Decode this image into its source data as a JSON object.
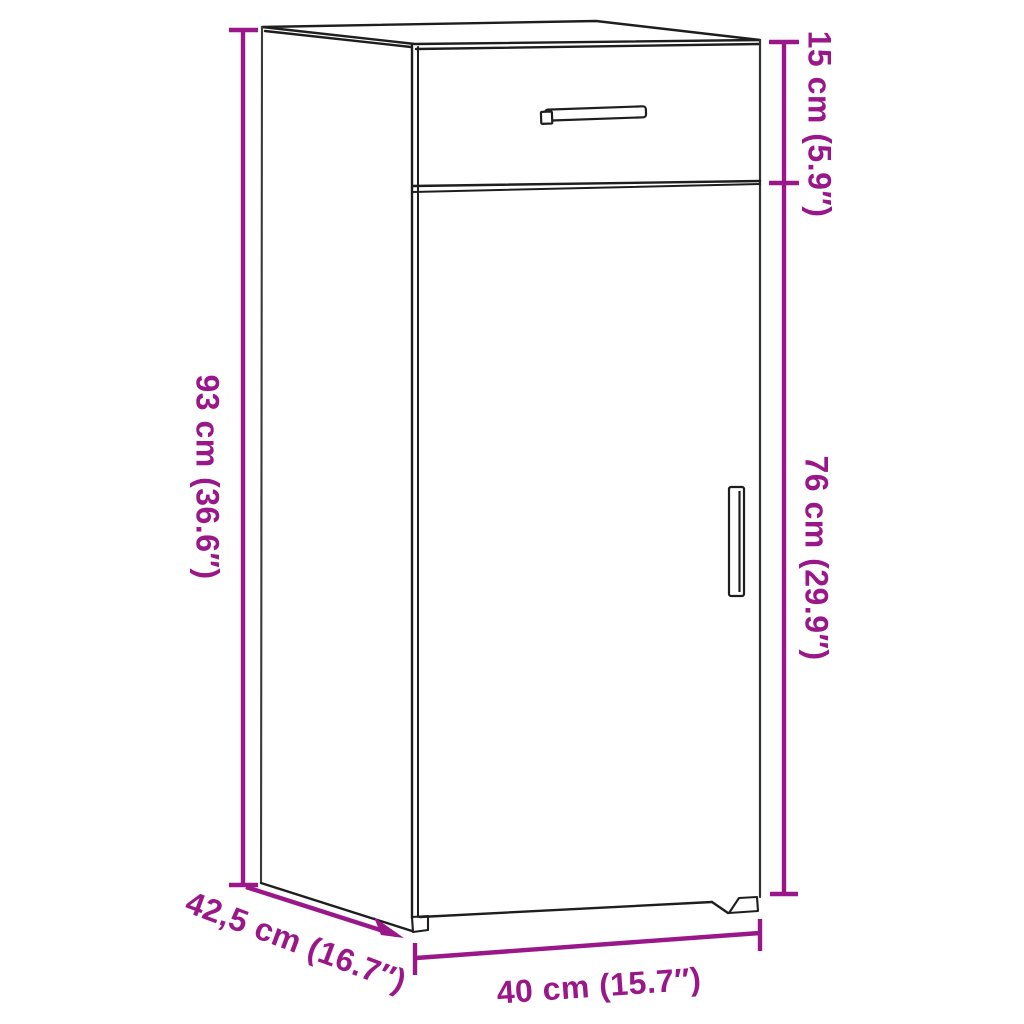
{
  "diagram": {
    "subject": "cabinet-with-drawer-and-door-dimension-diagram",
    "background_color": "#ffffff",
    "outline_color": "#1e1e1e",
    "dimension_color": "#9A1789",
    "dimensions": {
      "height": {
        "label": "93 cm (36.6″)",
        "cm": 93,
        "inches": 36.6
      },
      "upper_section": {
        "label": "15 cm (5.9″)",
        "cm": 15,
        "inches": 5.9
      },
      "lower_section": {
        "label": "76 cm (29.9″)",
        "cm": 76,
        "inches": 29.9
      },
      "depth": {
        "label": "42,5 cm (16.7″)",
        "cm": 42.5,
        "inches": 16.7
      },
      "width": {
        "label": "40 cm (15.7″)",
        "cm": 40,
        "inches": 15.7
      }
    }
  }
}
